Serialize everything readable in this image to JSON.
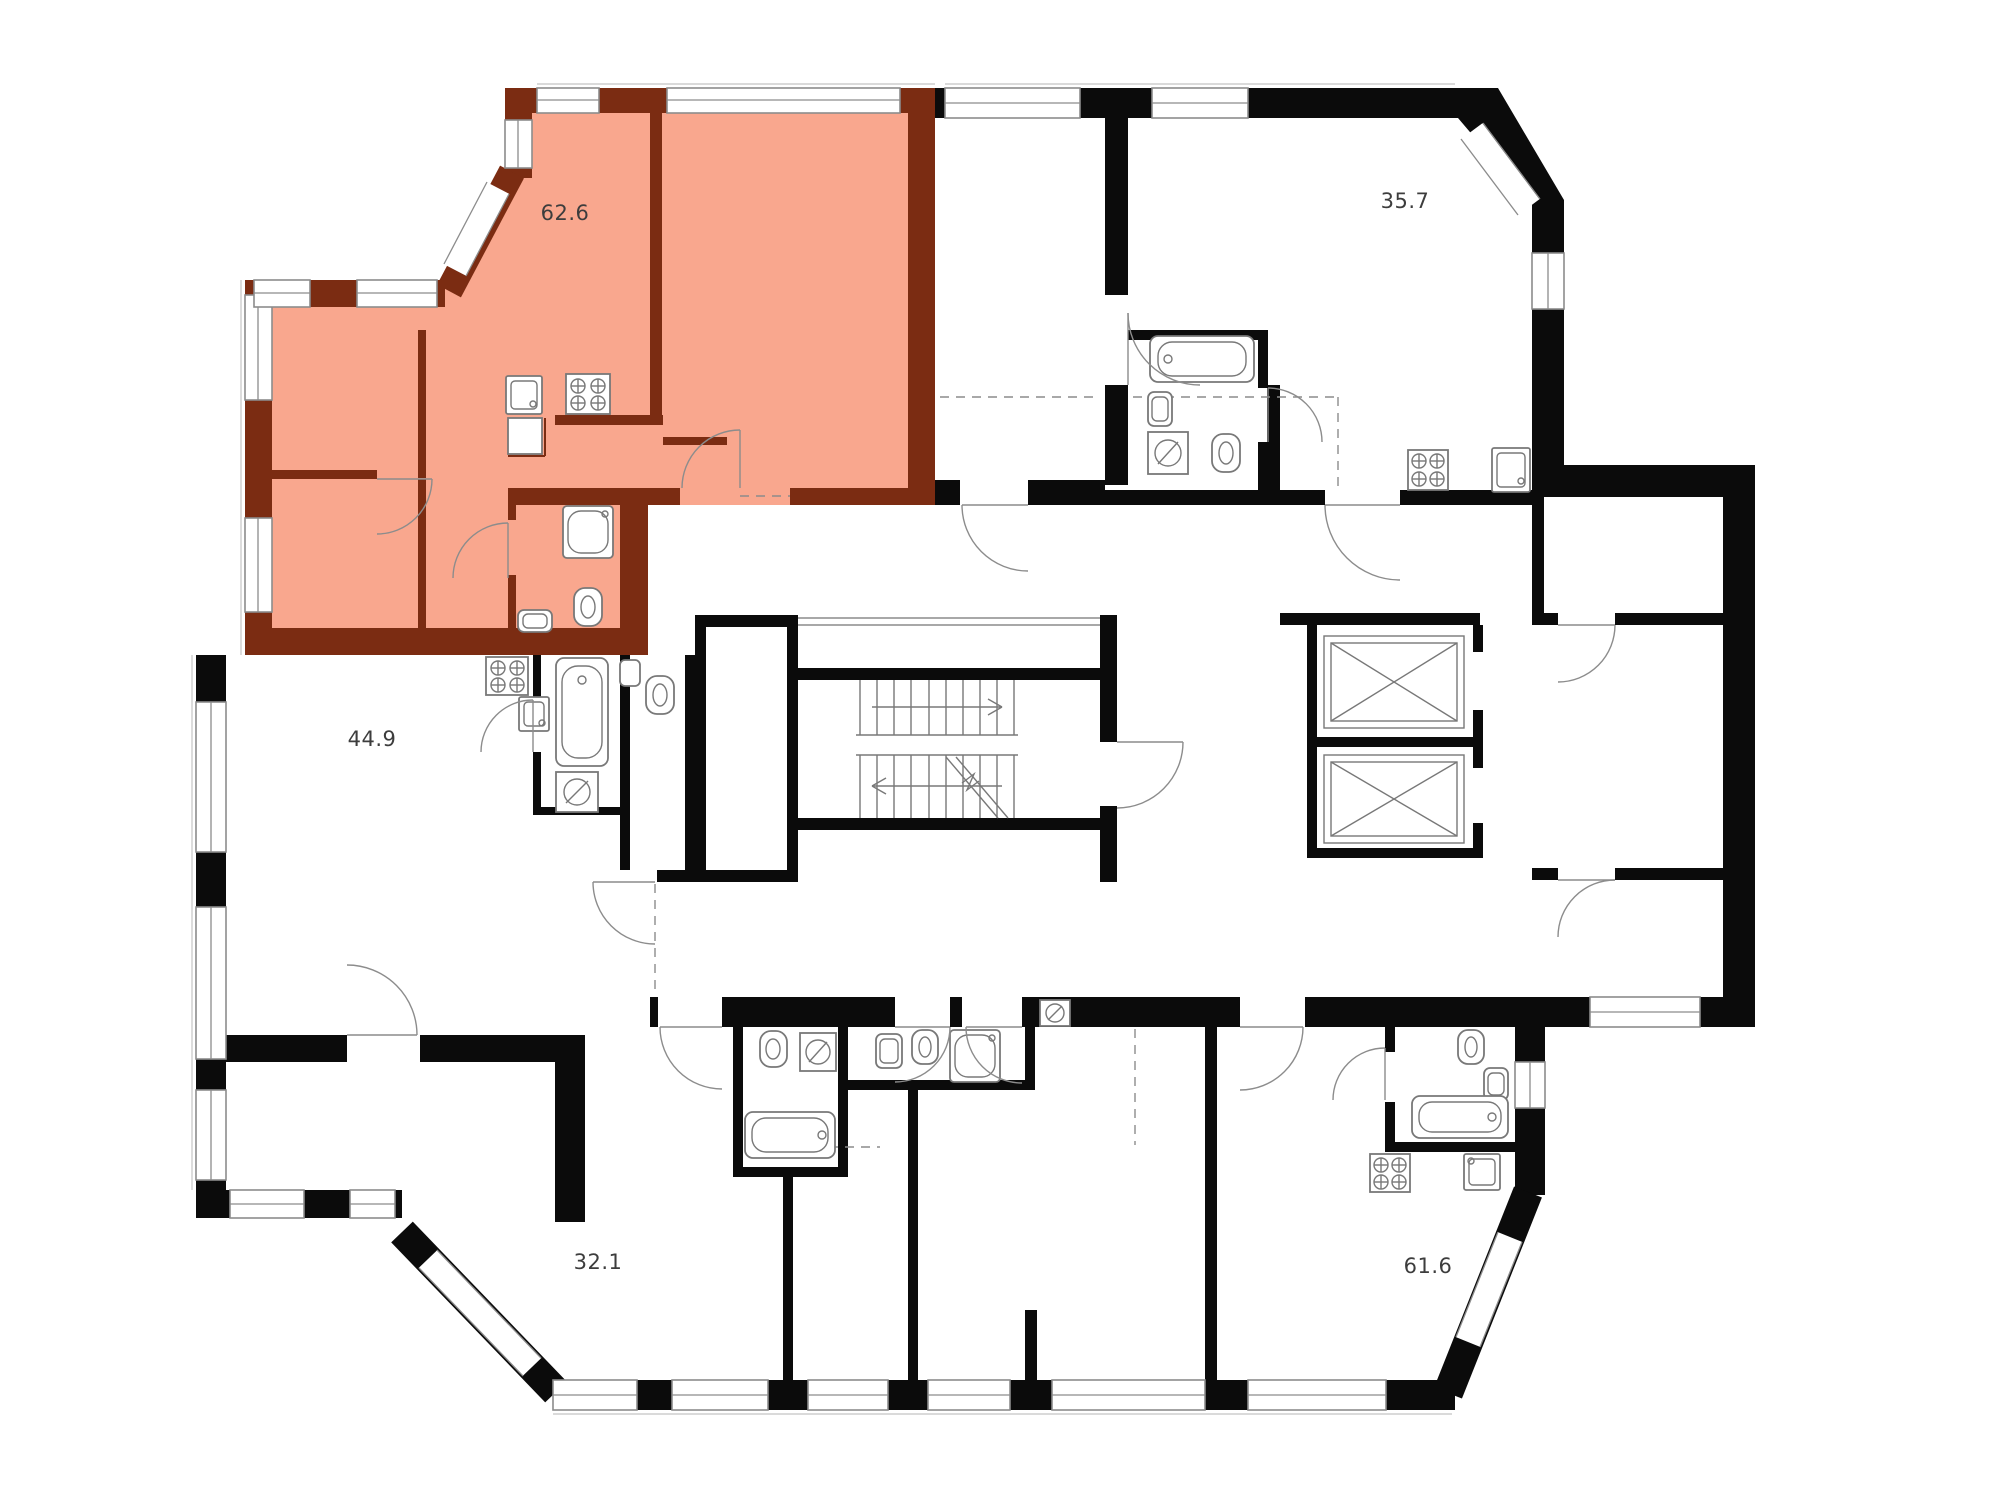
{
  "plan": {
    "units": [
      {
        "id": "unit-62-6",
        "area_label": "62.6",
        "highlighted": true
      },
      {
        "id": "unit-35-7",
        "area_label": "35.7",
        "highlighted": false
      },
      {
        "id": "unit-44-9",
        "area_label": "44.9",
        "highlighted": false
      },
      {
        "id": "unit-32-1",
        "area_label": "32.1",
        "highlighted": false
      },
      {
        "id": "unit-61-6",
        "area_label": "61.6",
        "highlighted": false
      }
    ],
    "colors": {
      "background": "#ffffff",
      "wall": "#0b0b0b",
      "highlight_fill": "#f9a78e",
      "highlight_wall": "#7b2c12",
      "line": "#8c8c8c",
      "fixture": "#787878",
      "label_text": "#3d3d3d"
    }
  }
}
